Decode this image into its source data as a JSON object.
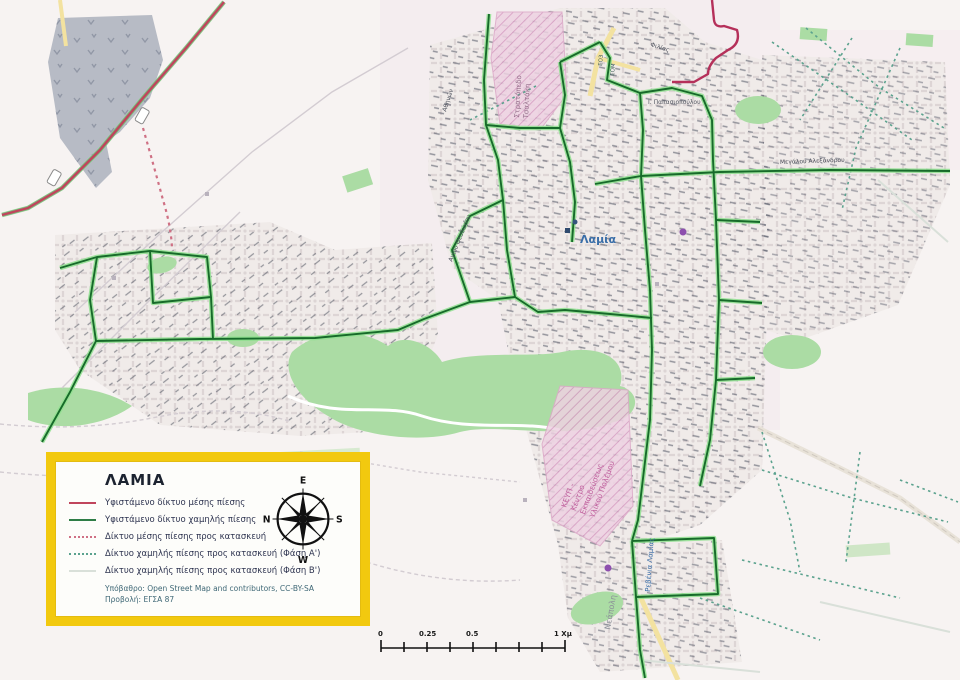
{
  "map": {
    "city_label": "Λαμία",
    "area_labels": {
      "camp1": "Στρατόπεδο",
      "camp2": "Τσαλτάκη",
      "keyp1": "ΚΕΥΠ -",
      "keyp2": "Κέντρο",
      "keyp3": "Εκπαιδεύσεως",
      "keyp4": "Υλικού Πολέμου",
      "neapoli": "Νεάπολη",
      "revenia": "Ρεβένια Λαμίας"
    },
    "street_labels": {
      "agiou_theodorou": "Αγίου Θεοδώρου",
      "megalou_alexandrou": "Μεγάλου Αλεξάνδρου",
      "filias": "Φιλίας",
      "athinon": "Αθηνών",
      "papasiopoulou": "Ι. Παπασιοπούλου",
      "eo3": "ΕΟ3",
      "eom": "ΕΟΜ"
    }
  },
  "legend": {
    "title": "ΛΑΜΙΑ",
    "items": [
      {
        "label": "Υφιστάμενο δίκτυο μέσης πίεσης",
        "color": "#c0455c",
        "style": "solid"
      },
      {
        "label": "Υφιστάμενο δίκτυο χαμηλής πίεσης",
        "color": "#2e7d46",
        "style": "solid"
      },
      {
        "label": "Δίκτυο μέσης πίεσης προς κατασκευή",
        "color": "#cf7084",
        "style": "dotted"
      },
      {
        "label": "Δίκτυο χαμηλής πίεσης προς κατασκευή (Φάση Α')",
        "color": "#5ba28e",
        "style": "dotted"
      },
      {
        "label": "Δίκτυο χαμηλής πίεσης προς κατασκευή (Φάση Β')",
        "color": "#d9e0d9",
        "style": "solid"
      }
    ],
    "notes": [
      "Υπόβαθρο: Open Street Map and contributors, CC-BY-SA",
      "Προβολή: ΕΓΣΑ 87"
    ]
  },
  "compass": {
    "top": "E",
    "right": "S",
    "bottom": "W",
    "left": "N"
  },
  "scale_bar": {
    "labels": [
      "0",
      "0.25",
      "0.5",
      "1 Χμ"
    ]
  },
  "colors": {
    "legend_border": "#f2c90f",
    "medium_existing": "#c0455c",
    "low_existing": "#2e7d46",
    "low_existing_halo": "#8fe08f",
    "medium_planned": "#cf7084",
    "low_planned_a": "#5ba28e",
    "low_planned_b": "#d9e0d9",
    "city_label_blue": "#3a6ea8",
    "military_gray": "#b7bbc5",
    "park_green": "#abdca4",
    "hatch_pink": "#e3bcd4",
    "map_background": "#f7f3f2"
  }
}
